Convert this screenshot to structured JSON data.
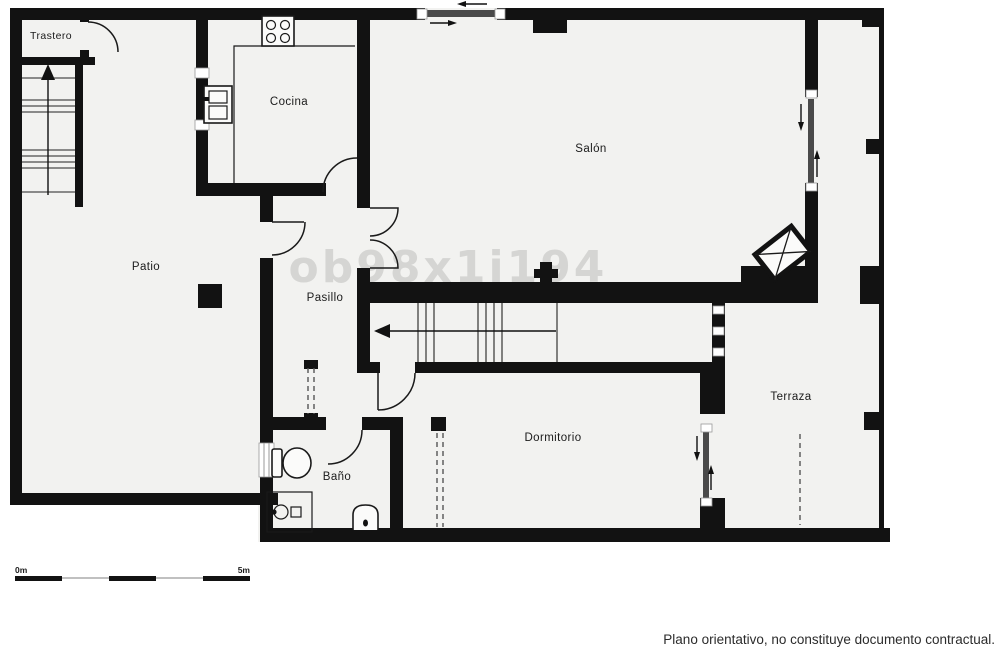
{
  "plan": {
    "watermark": "ob98x1i194",
    "disclaimer": "Plano orientativo, no constituye documento contractual.",
    "scale": {
      "start": "0m",
      "end": "5m"
    },
    "rooms": [
      {
        "name": "trastero",
        "label": "Trastero"
      },
      {
        "name": "cocina",
        "label": "Cocina"
      },
      {
        "name": "salon",
        "label": "Salón"
      },
      {
        "name": "patio",
        "label": "Patio"
      },
      {
        "name": "pasillo",
        "label": "Pasillo"
      },
      {
        "name": "terraza",
        "label": "Terraza"
      },
      {
        "name": "dormitorio",
        "label": "Dormitorio"
      },
      {
        "name": "bano",
        "label": "Baño"
      }
    ],
    "colors": {
      "wall": "#121212",
      "floor": "#f2f2f0",
      "background": "#ffffff",
      "watermark": "#bfbfbd",
      "text": "#1b1b1b"
    }
  }
}
